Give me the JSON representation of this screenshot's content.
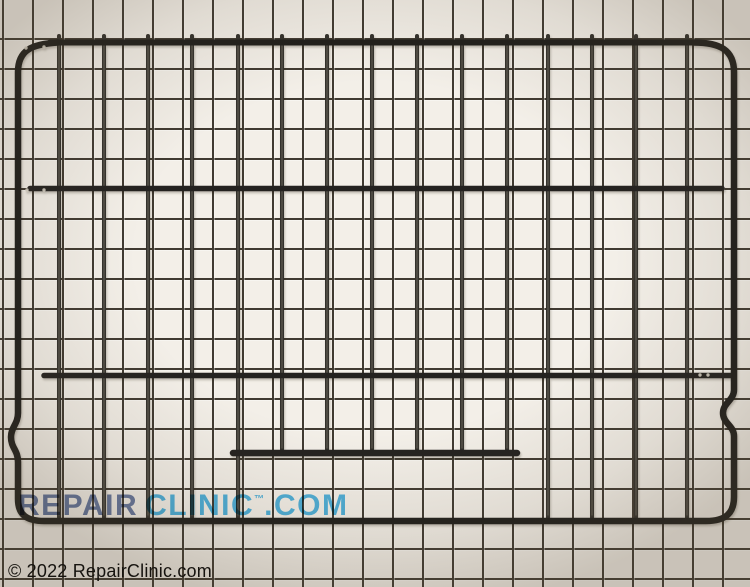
{
  "image": {
    "width": 750,
    "height": 587,
    "background": {
      "paper_color": "#f3efe8",
      "grid_line_color": "#403a31",
      "grid_cell_size_px": 30
    }
  },
  "watermark": {
    "repair_text": "REPAIR",
    "clinic_text": "CLINIC",
    "trademark_symbol": "™",
    "com_text": ".COM",
    "repair_color": "#6679a8",
    "clinic_color": "#45b5ec"
  },
  "footer": {
    "copyright_text": "© 2022 RepairClinic.com",
    "text_color": "#16130f"
  },
  "rack": {
    "description": "black wire oven rack",
    "frame_color": "#1f1e1b",
    "bar_color": "#242220",
    "wire_color": "#33312c",
    "wire_highlight_color": "#837f73",
    "rivet_color": "#d8d3c7",
    "rail": {
      "x1": 50,
      "x2": 700,
      "y": 42.5,
      "w": 6
    },
    "crossbars": [
      {
        "x1": 30,
        "x2": 722,
        "y": 188.5,
        "w": 5.5
      },
      {
        "x1": 44,
        "x2": 733,
        "y": 375.5,
        "w": 5.5
      }
    ],
    "partial_bar": {
      "x1": 233,
      "x2": 517,
      "y": 453,
      "w": 6.5
    },
    "wires": {
      "top_y": 36,
      "bottom_y": 519,
      "short_bottom_y": 450,
      "w": 4,
      "full_x": [
        59,
        104,
        148,
        192,
        238,
        548,
        592,
        636,
        687
      ],
      "short_x": [
        282,
        327,
        372,
        417,
        462,
        507
      ]
    },
    "rivets": [
      [
        27,
        190
      ],
      [
        44,
        190
      ],
      [
        700,
        375
      ],
      [
        708,
        375
      ],
      [
        26,
        48
      ],
      [
        44,
        47
      ]
    ]
  }
}
